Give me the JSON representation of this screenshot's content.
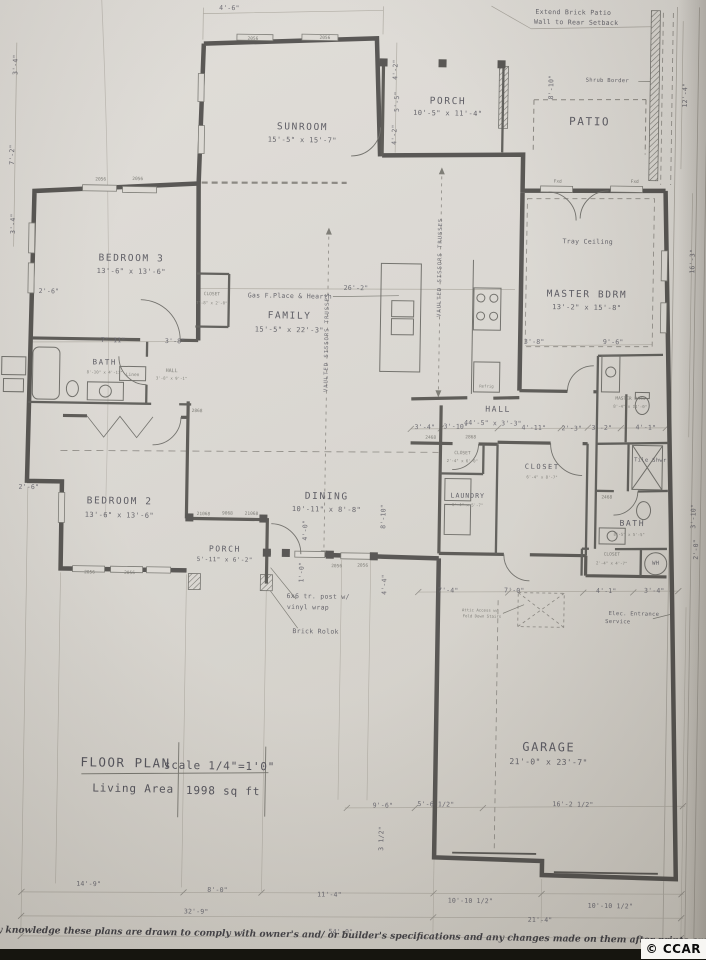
{
  "sheet": {
    "title": "FLOOR PLAN",
    "scale": "scale 1/4\"=1'0\"",
    "living_area_label": "Living Area",
    "living_area_value": "1998 sq ft",
    "disclaimer": "y knowledge these plans are drawn to comply with owner's and/ or builder's specifications and any changes made on them after prints are made",
    "logo": "© CCAR"
  },
  "rooms": {
    "sunroom": {
      "name": "SUNROOM",
      "size": "15'-5\" x 15'-7\""
    },
    "porch_rear": {
      "name": "PORCH",
      "size": "10'-5\" x 11'-4\""
    },
    "patio": {
      "name": "PATIO"
    },
    "bedroom3": {
      "name": "BEDROOM 3",
      "size": "13'-6\" x 13'-6\""
    },
    "family": {
      "name": "FAMILY",
      "size": "15'-5\" x 22'-3\""
    },
    "master": {
      "name": "MASTER BDRM",
      "size": "13'-2\" x 15'-8\""
    },
    "bath_main": {
      "name": "BATH",
      "size": "8'-10\" x 4'-11\""
    },
    "hall_small": {
      "name": "HALL",
      "size": "3'-8\" x 9'-1\""
    },
    "bedroom2": {
      "name": "BEDROOM 2",
      "size": "13'-6\" x 13'-6\""
    },
    "dining": {
      "name": "DINING",
      "size": "10'-11\" x 8'-8\""
    },
    "porch_front": {
      "name": "PORCH",
      "size": "5'-11\" x 6'-2\""
    },
    "hall": {
      "name": "HALL",
      "size": "44'-5\" x 3'-3\""
    },
    "laundry": {
      "name": "LAUNDRY",
      "size": "6'-4\" x 5'-7\""
    },
    "closet_laundry": {
      "name": "CLOSET",
      "size": "2'-4\" x 6'-0\""
    },
    "closet_center": {
      "name": "CLOSET",
      "size": "6'-4\" x 8'-7\""
    },
    "closet_bed3": {
      "name": "CLOSET",
      "size": "7'-8\" x 2'-0\""
    },
    "master_bath": {
      "name": "MASTER BATH",
      "size": "8'-4\" x 11'-0\""
    },
    "tile_shower": {
      "name": "Tile Shwr"
    },
    "bath2": {
      "name": "BATH",
      "size": "8'-5\" x 5'-5\""
    },
    "closet_master": {
      "name": "CLOSET",
      "size": "2'-4\" x 4'-7\""
    },
    "water_heater": {
      "name": "WH"
    },
    "garage": {
      "name": "GARAGE",
      "size": "21'-0\" x 23'-7\""
    },
    "linen": {
      "name": "Linen"
    },
    "refrig": {
      "name": "Refrig"
    }
  },
  "notes": {
    "extend_patio_1": "Extend Brick Patio",
    "extend_patio_2": "Wall to Rear Setback",
    "shrub_border": "Shrub Border",
    "tray_ceiling": "Tray Ceiling",
    "gas_fireplace": "Gas F.Place & Hearth",
    "vaulted_trusses": "VAULTED SISSORS TRUSSES",
    "post_wrap_1": "6x6 tr. post w/",
    "post_wrap_2": "vinyl wrap",
    "brick_rolok": "Brick Rolok",
    "attic_access_1": "Attic Access w/",
    "attic_access_2": "Fold Down Stairs",
    "elec_service_1": "Elec. Entrance",
    "elec_service_2": "Service"
  },
  "dims": {
    "top_sunroom": "4'-6\"",
    "porch_left_a": "4'-2\"",
    "porch_left_b": "5'-5\"",
    "porch_left_c": "4'-2\"",
    "porch_right": "8'-10\"",
    "patio_right": "12'-4\"",
    "left_a": "3'-4\"",
    "left_b": "7'-2\"",
    "left_c": "3'-4\"",
    "bed3_left": "2'-6\"",
    "bed3_a": "7'-11\"",
    "bed3_b": "3'-8\"",
    "family_w": "26'-2\"",
    "master_a": "3'-8\"",
    "master_b": "9'-6\"",
    "right_master": "16'-3\"",
    "bed2_left": "2'-6\"",
    "hall_a": "3'-4\"",
    "hall_b": "3'-10\"",
    "hall_c": "4'-11\"",
    "hall_d": "2'-3\"",
    "hall_e": "3'-2\"",
    "hall_f": "4'-1\"",
    "dining_a": "4'-0\"",
    "dining_b": "1'-0\"",
    "dining_c": "8'-10\"",
    "dining_d": "4'-4\"",
    "garage_a": "7'-4\"",
    "garage_b": "7'-0\"",
    "garage_c": "4'-1\"",
    "garage_d": "3'-4\"",
    "right_a": "3'-10\"",
    "right_b": "2'-0\"",
    "front_a": "9'-6\"",
    "front_b": "5'-6 1/2\"",
    "front_c": "16'-2 1/2\"",
    "step": "3 1/2\"",
    "bottom_a": "14'-9\"",
    "bottom_b": "8'-0\"",
    "bottom_c": "11'-4\"",
    "bottom_d": "10'-10 1/2\"",
    "bottom_e": "10'-10 1/2\"",
    "bottom_f": "32'-9\"",
    "bottom_g": "21'-4\"",
    "bottom_h": "54'-0\""
  },
  "tags": [
    "2056",
    "2056",
    "2056",
    "2056",
    "Fxd",
    "Fxd",
    "21068",
    "9068",
    "21068",
    "2056",
    "2056",
    "2468",
    "2868",
    "2468",
    "2868",
    "2056",
    "2056"
  ]
}
